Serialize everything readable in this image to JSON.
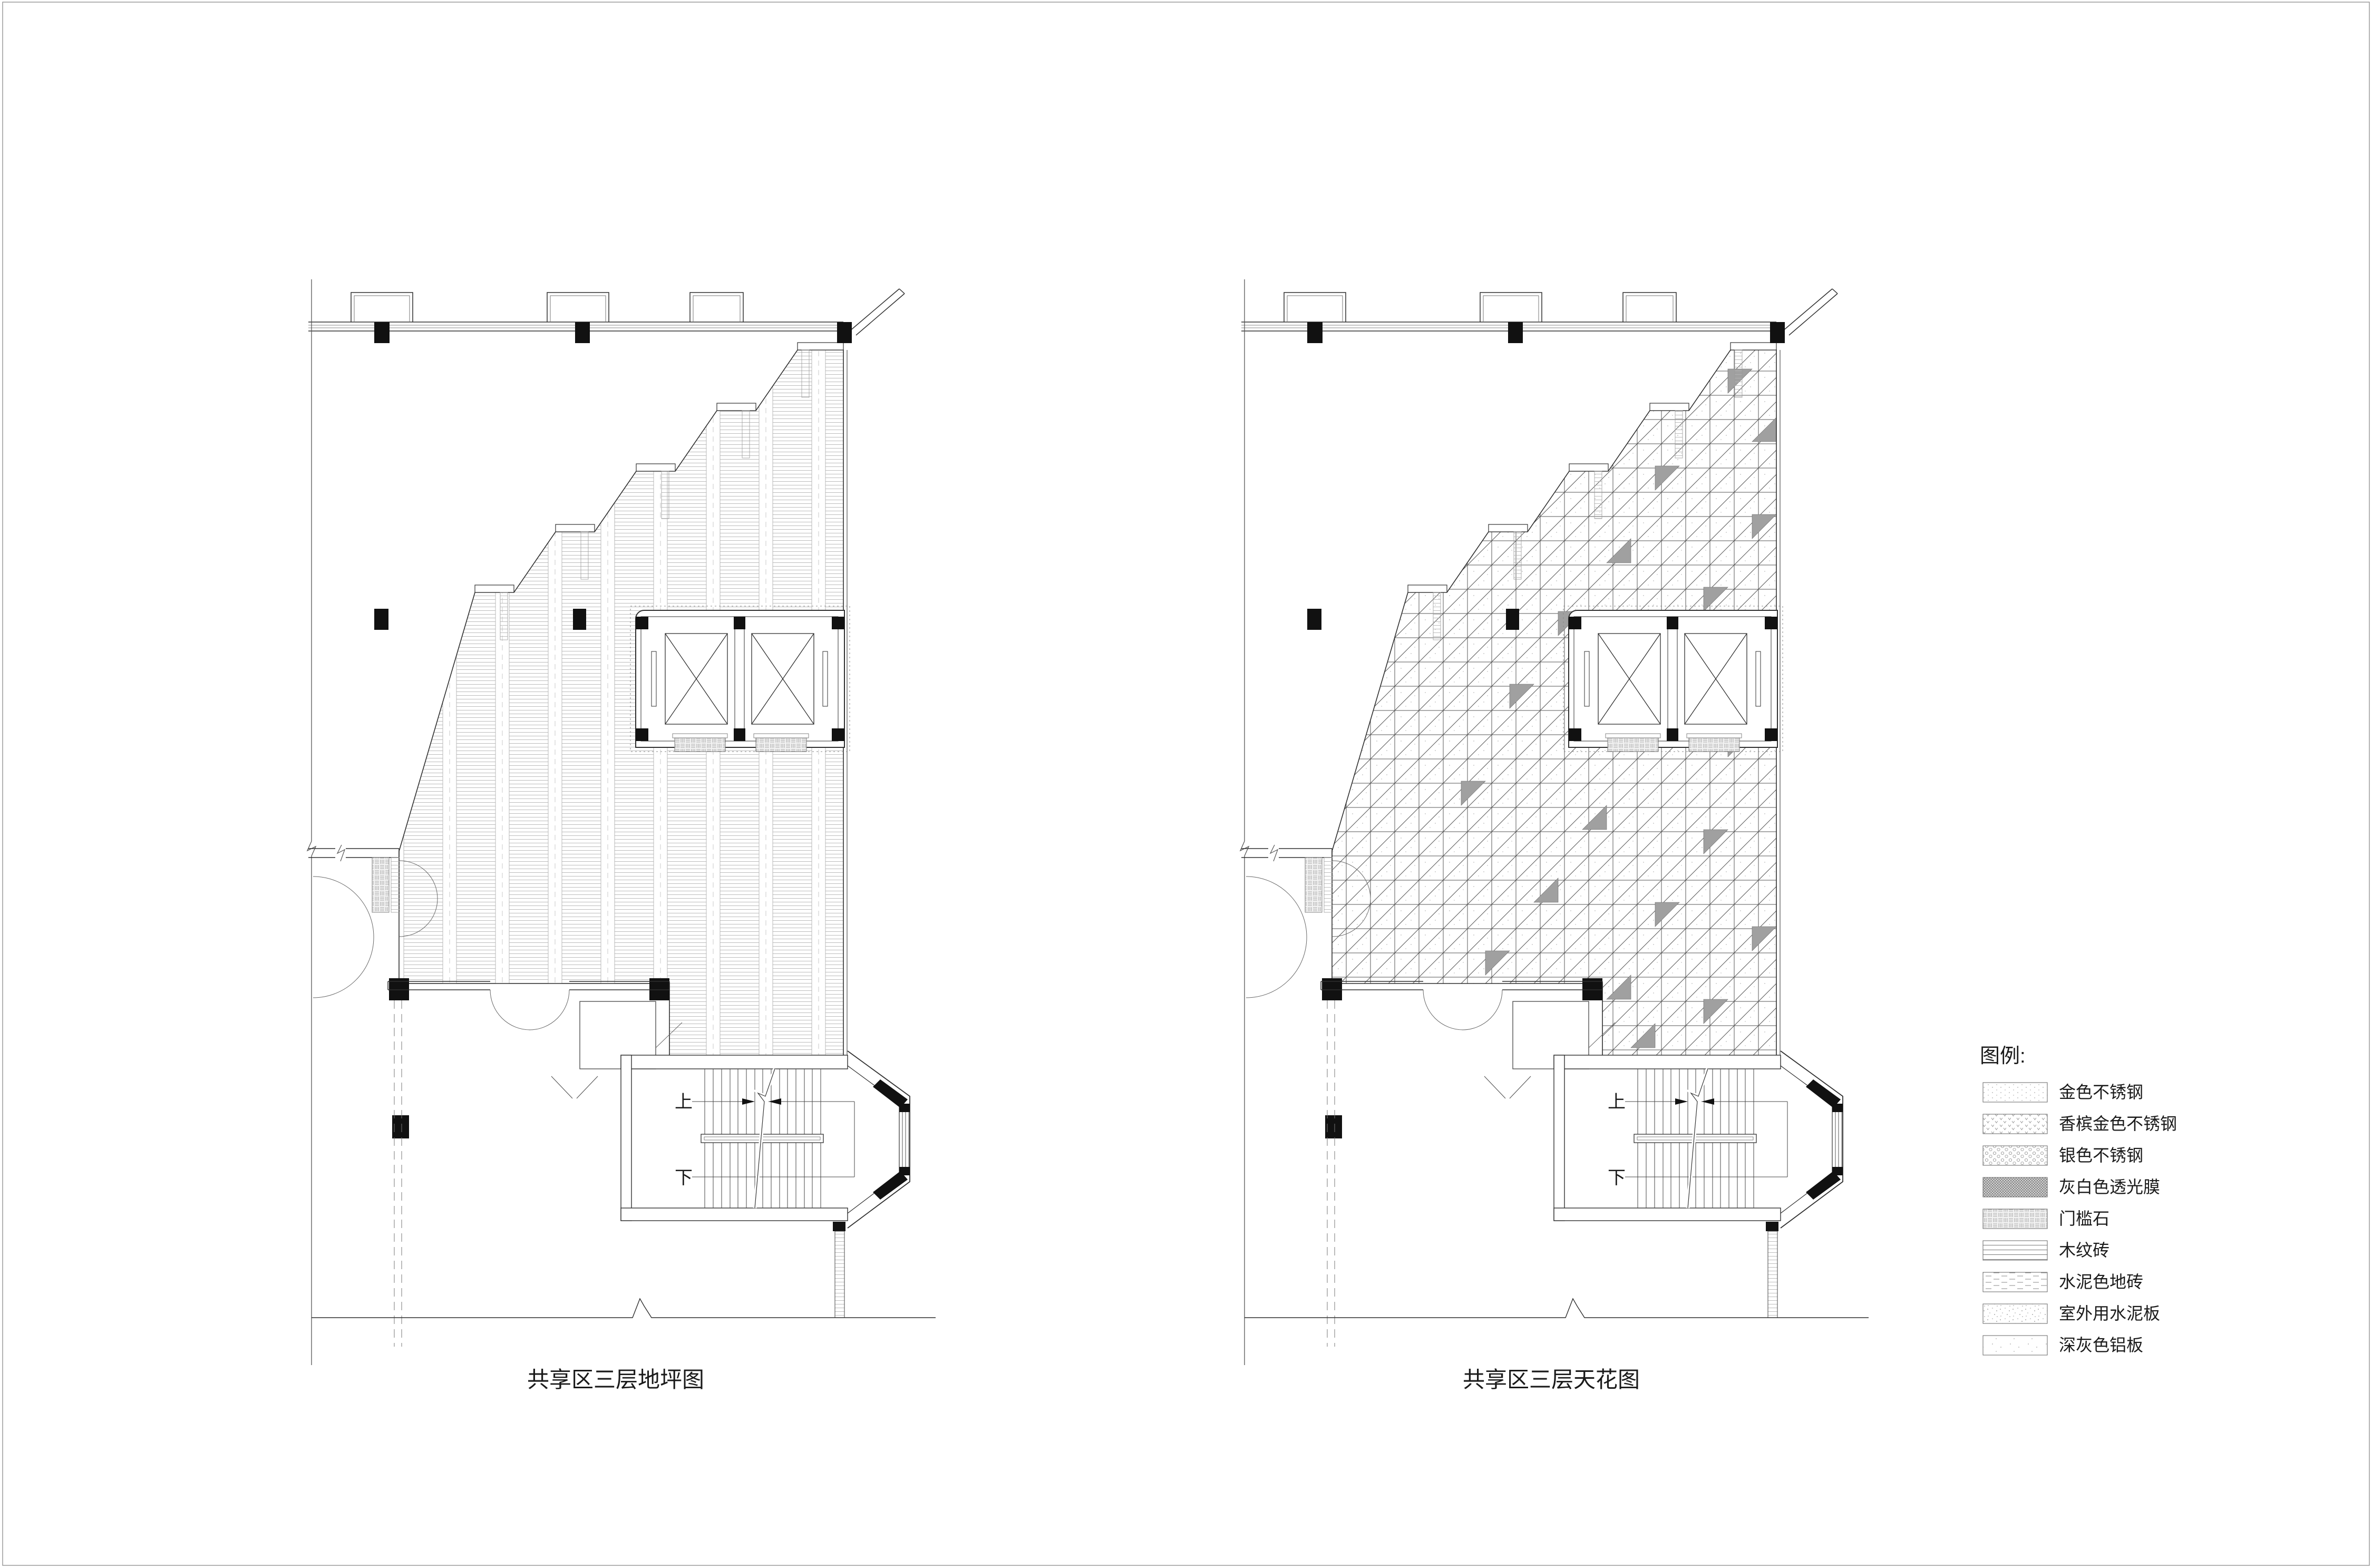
{
  "sheet": {
    "background": "#ffffff",
    "border_color": "#9a9a9a",
    "line_color": "#2f2f2f"
  },
  "plans": [
    {
      "id": "floor-finish-plan",
      "title": "共享区三层地坪图",
      "stair_up_label": "上",
      "stair_down_label": "下",
      "fill_style": "wood-grain-horizontal-hatch"
    },
    {
      "id": "ceiling-plan",
      "title": "共享区三层天花图",
      "stair_up_label": "上",
      "stair_down_label": "下",
      "fill_style": "diagonal-grid-ceiling-panels"
    }
  ],
  "legend": {
    "title": "图例:",
    "items": [
      {
        "label": "金色不锈钢",
        "pattern": "gold-stainless-dots"
      },
      {
        "label": "香槟金色不锈钢",
        "pattern": "champagne-gold-triangles"
      },
      {
        "label": "银色不锈钢",
        "pattern": "silver-stainless-circles"
      },
      {
        "label": "灰白色透光膜",
        "pattern": "gray-white-translucent-film-crosshatch"
      },
      {
        "label": "门槛石",
        "pattern": "threshold-stone-basketweave"
      },
      {
        "label": "木纹砖",
        "pattern": "wood-grain-lines"
      },
      {
        "label": "水泥色地砖",
        "pattern": "cement-color-tile-dashes"
      },
      {
        "label": "室外用水泥板",
        "pattern": "outdoor-cement-board-speckle"
      },
      {
        "label": "深灰色铝板",
        "pattern": "dark-gray-aluminum-speckle"
      }
    ]
  }
}
